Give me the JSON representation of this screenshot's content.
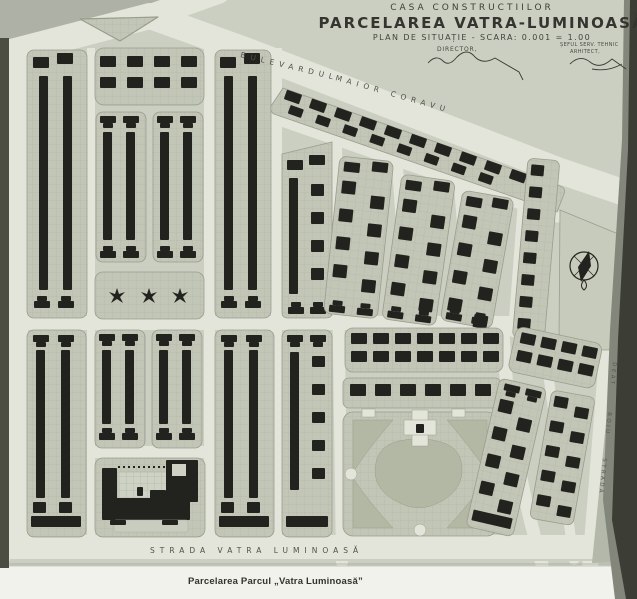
{
  "header": {
    "line1": "CASA CONSTRUCTIILOR",
    "line2": "PARCELAREA VATRA-LUMINOASĂ",
    "line3": "PLAN DE SITUAȚIE - SCARA: 0.001 = 1.00"
  },
  "signatures": {
    "left_role": "DIRECTOR,",
    "right_role_line1": "ȘEFUL SERV. TEHNIC",
    "right_role_line2": "ARHITECT,"
  },
  "streets": {
    "boulevard_part1": "BULEVARDUL",
    "boulevard_part2": "MAIOR  CORAVU",
    "bottom_street": "STRADA  VATRA  LUMINOASĂ",
    "right_street_upper": "DEAT",
    "right_street_middle": "BOIU",
    "right_street_lower": "STRADA"
  },
  "caption": "Parcelarea Parcul „Vatra Luminoasă”",
  "icons": {
    "compass": "compass-rose-icon",
    "trees": "tree-icon",
    "traffic_island": "traffic-island",
    "park": "public-park",
    "plaza": "market-square",
    "school": "public-building"
  },
  "colors": {
    "page": "#cbcfc2",
    "street": "#e3e5da",
    "block": "#c2c6b7",
    "grid_line": "#aeb2a3",
    "building": "#22231e",
    "lawn": "#b3b8a5",
    "photo_edge": "#3c3e36",
    "paper_margin": "#f2f2ed",
    "ink": "#3e3f37"
  }
}
